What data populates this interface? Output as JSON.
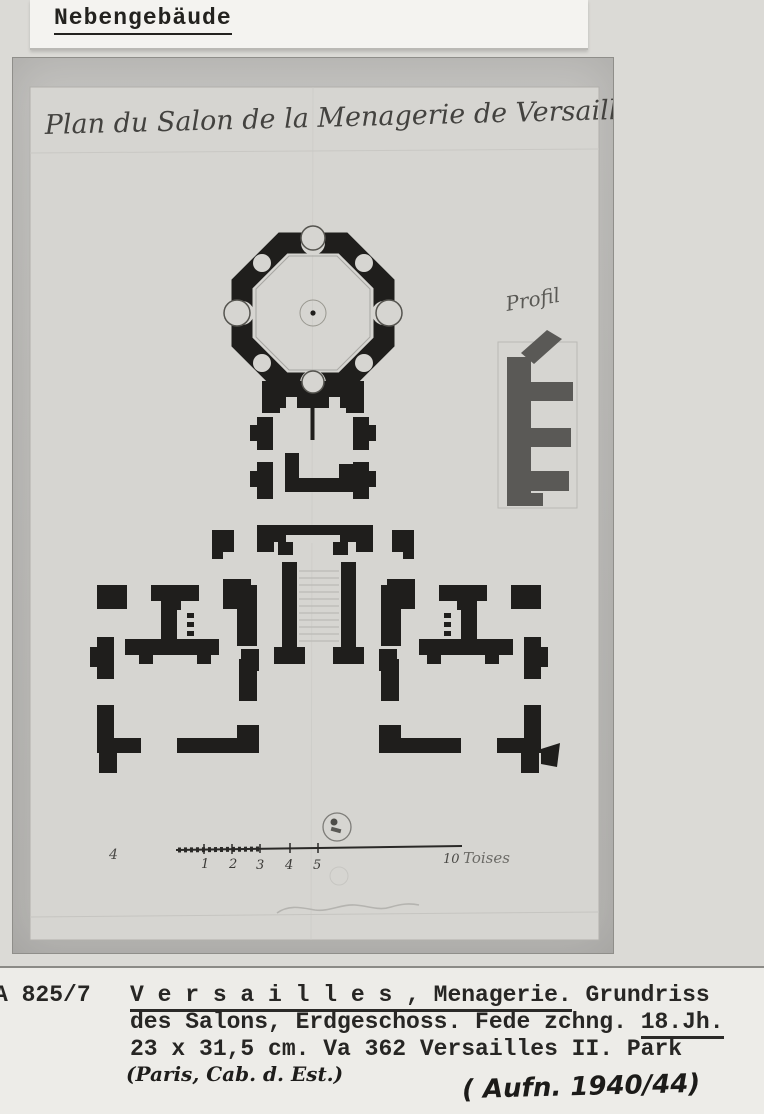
{
  "archive_label": {
    "text": "Nebengebäude"
  },
  "photo": {
    "plan_title": "Plan du Salon de la Menagerie de Versailles",
    "profil_label": "Profil",
    "scale_bar": {
      "left_mark": "4",
      "tick_labels": [
        "1",
        "2",
        "3",
        "4",
        "5"
      ],
      "end_label": "10",
      "unit_label": "Toises"
    }
  },
  "caption": {
    "inventory_number": "A 825/7",
    "line1_underlined": "V e r s a i l l e s , Menagerie.",
    "line1_rest": " Grundriss",
    "line2_main": "des Salons, Erdgeschoss. Fede zchng. ",
    "line2_underlined": "18.Jh.",
    "line3": "23 x 31,5 cm. Va 362 Versailles II. Park",
    "handwritten_location": "(Paris, Cab. d. Est.)",
    "handwritten_photo_note": "( Aufn. 1940/44)"
  },
  "colors": {
    "photo_gray": "#bdbcb9",
    "sheet_gray": "#d6d5d1",
    "ink_black": "#1f1e1c",
    "paper_white": "#edece8"
  }
}
